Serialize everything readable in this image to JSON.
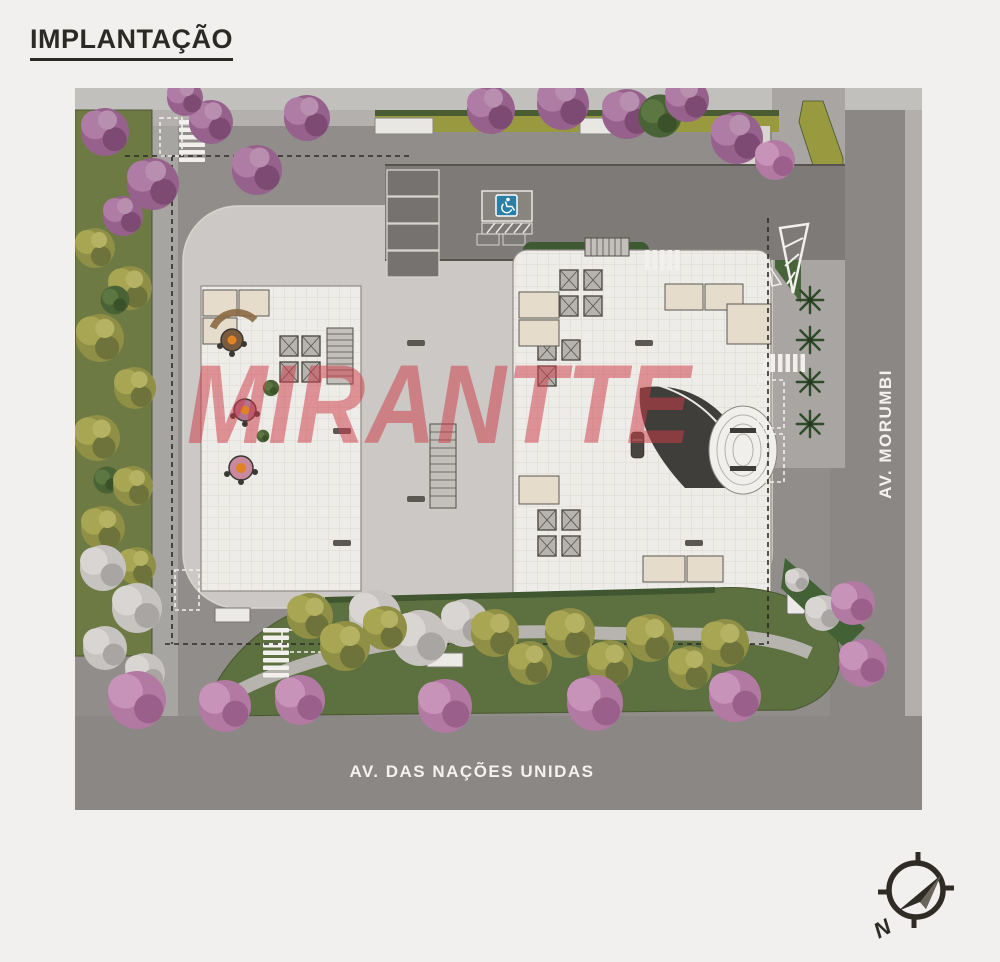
{
  "page": {
    "title": "IMPLANTAÇÃO"
  },
  "plan": {
    "watermark": "MIRANTTE",
    "streets": {
      "vertical": "AV. MORUMBI",
      "horizontal": "AV. DAS NAÇÕES UNIDAS"
    },
    "compass": {
      "north": "N"
    },
    "colors": {
      "watermark_red": "#d0434c",
      "accessible_sign_blue": "#2b7fa6",
      "road_gray": "#8a8785",
      "sidewalk_gray": "#b3b0ad",
      "plaza_concrete": "#cbc8c5",
      "building_tile_white": "#eeece8",
      "garden_green": "#5d7040",
      "olive_tree": "#8f8f45",
      "flower_tree_purple": "#96618c",
      "flower_tree_pink": "#b279a2",
      "title_text": "#2b2a26"
    }
  }
}
